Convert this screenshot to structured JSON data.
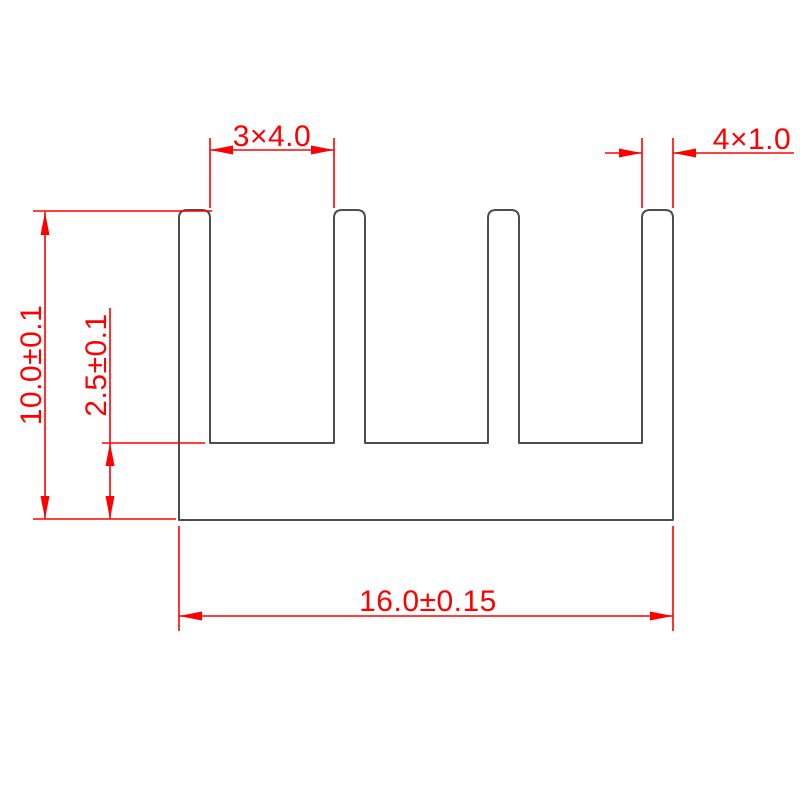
{
  "drawing": {
    "colors": {
      "dimension_lines": "#fe0000",
      "profile_outline": "#4d4d4d",
      "background": "#ffffff"
    },
    "dimensions": {
      "fin_spacing": {
        "label": "3×4.0"
      },
      "fin_thickness": {
        "label": "4×1.0"
      },
      "overall_height": {
        "label": "10.0±0.1"
      },
      "base_thickness": {
        "label": "2.5±0.1"
      },
      "overall_width": {
        "label": "16.0±0.15"
      }
    }
  }
}
